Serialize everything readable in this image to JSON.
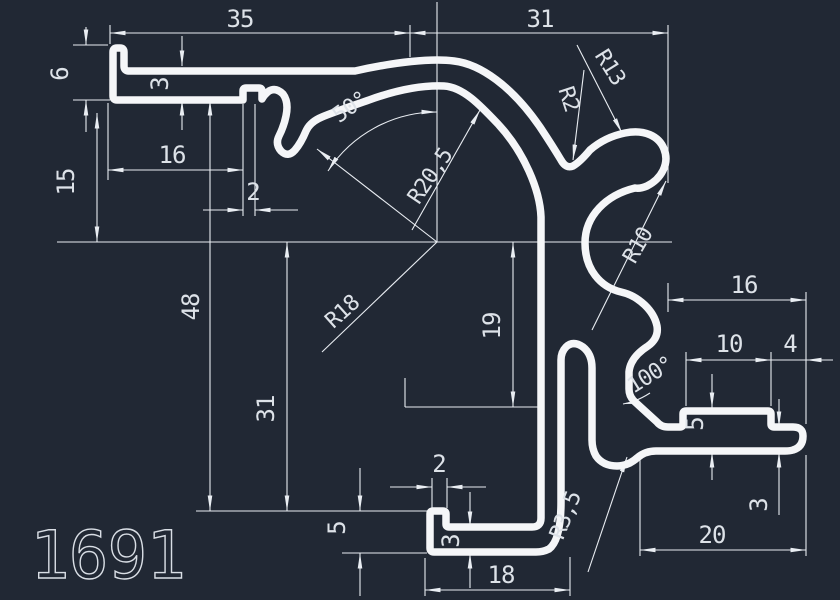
{
  "drawing": {
    "part_number": "1691",
    "colors": {
      "background": "#212834",
      "profile_line": "#f5f6f8",
      "dim_line": "#e9edf2",
      "text": "#dde2e8"
    },
    "dimensions": {
      "d35": "35",
      "d31_top": "31",
      "d6": "6",
      "d3_plate": "3",
      "d16_left": "16",
      "d2_notch": "2",
      "d15": "15",
      "d48": "48",
      "d31_side": "31",
      "d19": "19",
      "a50": "50°",
      "r20_5": "R20,5",
      "r18": "R18",
      "r13": "R13",
      "r2": "R2",
      "r10": "R10",
      "d16_right": "16",
      "d10": "10",
      "d4": "4",
      "a100": "100°",
      "d5_step": "5",
      "d3_bar": "3",
      "d20": "20",
      "d18": "18",
      "d5_foot": "5",
      "d3_foot": "3",
      "d2_stub": "2",
      "r3_5": "R3,5"
    }
  }
}
